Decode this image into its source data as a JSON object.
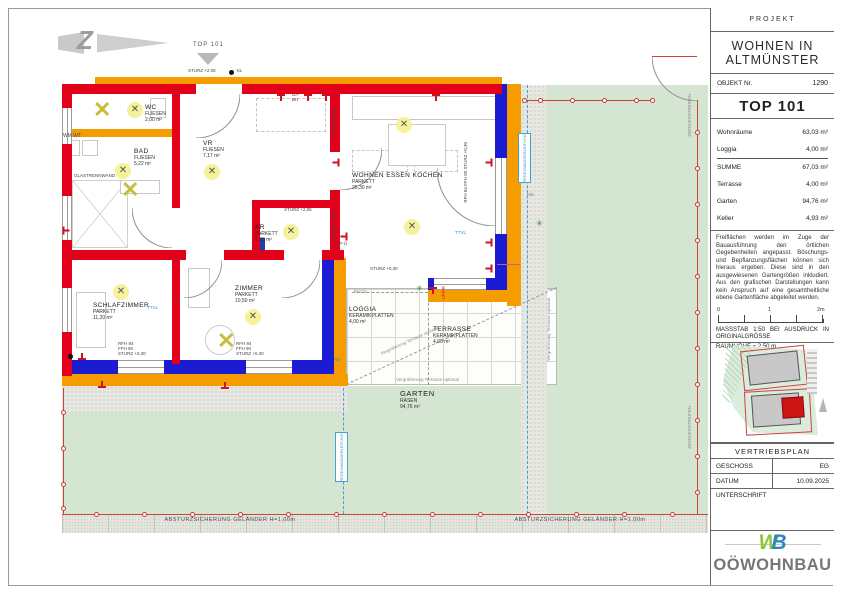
{
  "panel": {
    "projekt_label": "PROJEKT",
    "project_line1": "WOHNEN IN",
    "project_line2": "ALTMÜNSTER",
    "objekt_label": "OBJEKT Nr.",
    "objekt_nr": "1290",
    "top": "TOP 101",
    "areas": [
      {
        "label": "Wohnräume",
        "value": "63,03 m²"
      },
      {
        "label": "Loggia",
        "value": "4,00 m²"
      },
      {
        "label": "SUMME",
        "value": "67,03 m²"
      },
      {
        "label": "Terrasse",
        "value": "4,00 m²"
      },
      {
        "label": "Garten",
        "value": "94,76 m²"
      },
      {
        "label": "Keller",
        "value": "4,93 m²"
      }
    ],
    "disclaimer": "Freiflächen werden im Zuge der Bauausführung den örtlichen Gegebenheiten angepasst. Böschungs- und Bepflanzungsflächen können sich hieraus ergeben. Diese sind in den ausgewiesenen Gartengrößen inkludiert. Aus den grafischen Darstellungen kann kein Anspruch auf eine gesamtheitliche ebene Gartenfläche abgeleitet werden.",
    "scale_ticks": {
      "t0": "0",
      "t1": "1",
      "t2": "2m"
    },
    "massstab": "MASSSTAB 1:50 BEI AUSDRUCK IN ORIGINALGRÖSSE",
    "raumhoehe": "RAUMHÖHE = 2,50 m",
    "vertriebsplan": "VERTRIEBSPLAN",
    "geschoss_label": "GESCHOSS",
    "geschoss": "EG",
    "datum_label": "DATUM",
    "datum": "10.09.2025",
    "unterschrift_label": "UNTERSCHRIFT",
    "logo_w": "W",
    "logo_b": "B",
    "logo_text": "OÖWOHNBAU"
  },
  "plan": {
    "north_mark": "Z",
    "icons": {
      "light_cross": "✕",
      "pendant_cross": "✕",
      "green_star": "✳"
    },
    "rooms": {
      "wc": {
        "name": "WC",
        "finish": "FLIESEN",
        "area": "2,00 m²"
      },
      "bad": {
        "name": "BAD",
        "finish": "FLIESEN",
        "area": "5,22 m²"
      },
      "vr": {
        "name": "VR",
        "finish": "FLIESEN",
        "area": "7,17 m²"
      },
      "wohnen": {
        "name": "WOHNEN ESSEN KOCHEN",
        "finish": "PARKETT",
        "area": "25,30 m²"
      },
      "ar": {
        "name": "AR",
        "finish": "PARKETT",
        "area": "1,78 m²"
      },
      "schlaf": {
        "name": "SCHLAFZIMMER",
        "finish": "PARKETT",
        "area": "11,20 m²"
      },
      "zimmer": {
        "name": "ZIMMER",
        "finish": "PARKETT",
        "area": "10,50 m²"
      },
      "loggia": {
        "name": "LOGGIA",
        "finish": "KERAMIKPLATTEN",
        "area": "4,00 m²"
      },
      "terrasse": {
        "name": "TERRASSE",
        "finish": "KERAMIKPLATTEN",
        "area": "4,00 m²"
      },
      "garten": {
        "name": "GARTEN",
        "finish": "RASEN",
        "area": "94,76 m²"
      }
    },
    "annotations": {
      "top_entry": "TOP 101",
      "sturz205": "STURZ +2,05",
      "sturz030": "STURZ +0,30",
      "kl": "KL",
      "da_bh": "DA\nBH",
      "wm_wt": "WM WT",
      "glastrennwand": "GLASTRENNWAND",
      "ttvl": "TTVL",
      "kat": "KAT-Ü",
      "rigol": "RIGOL",
      "upfr": "UP/FR",
      "rr": "RR",
      "mb": "MB",
      "win_stack": "RFH 84\nFFH 90\nSTURZ +0,30",
      "terr_opt": "Vergrößerung Terrasse optional",
      "absturz": "ABSTURZSICHERUNG GELÄNDER H=1,00m",
      "zierkies": "ZIERKIESSTREIFEN",
      "blueline": "REGENWASSERLEITUNG"
    },
    "colors": {
      "wall_red": "#e2001a",
      "wall_orange": "#f59c00",
      "wall_blue": "#1b1bd1",
      "garden_green": "#d4e6d2",
      "unit_red": "#cc1414"
    }
  }
}
